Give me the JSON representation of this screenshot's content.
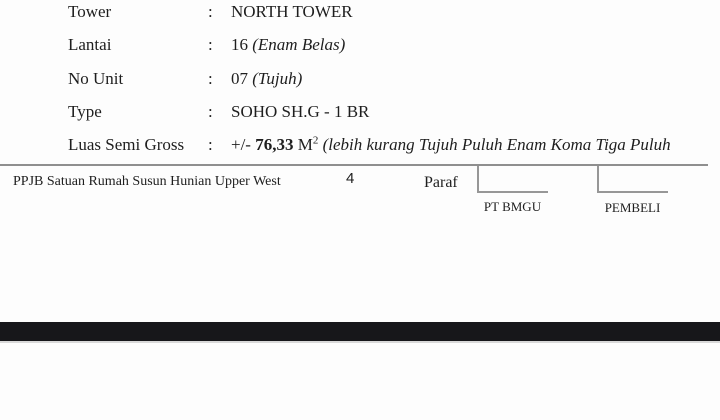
{
  "page": {
    "background_color": "#fdfdfd",
    "text_color": "#1e1e1e",
    "line_color": "#8f8f8f",
    "bar_color": "#17171a"
  },
  "details": {
    "colon": ":",
    "rows": [
      {
        "label": "Tower",
        "value": "NORTH TOWER"
      },
      {
        "label": "Lantai",
        "value_main": "16 ",
        "value_italic": "(Enam Belas)"
      },
      {
        "label": "No Unit",
        "value_main": "07 ",
        "value_italic": "(Tujuh)"
      },
      {
        "label": "Type",
        "value": "SOHO SH.G - 1 BR"
      },
      {
        "label": "Luas Semi Gross",
        "value_prefix": "+/- ",
        "value_bold": "76,33",
        "value_unit": " M",
        "value_superscript": "2",
        "value_italic": " (lebih kurang Tujuh Puluh Enam Koma Tiga Puluh"
      }
    ]
  },
  "footer": {
    "doc_title": "PPJB Satuan Rumah Susun Hunian Upper West",
    "page_number": "4",
    "paraf_label": "Paraf",
    "signatories": [
      {
        "name": "PT BMGU"
      },
      {
        "name": "PEMBELI"
      }
    ]
  }
}
